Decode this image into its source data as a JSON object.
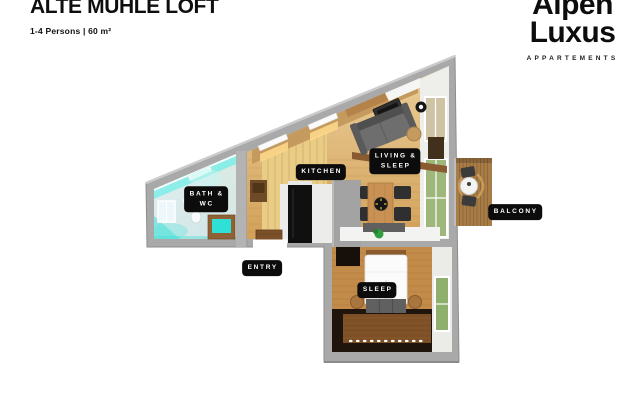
{
  "header": {
    "title": "ALTE MÜHLE LOFT",
    "subtitle": "1-4 Persons | 60 m²"
  },
  "logo": {
    "line1": "Alpen",
    "line2": "Luxus",
    "tagline": "APPARTEMENTS"
  },
  "floorplan": {
    "labels": {
      "bath_line1": "BATH &",
      "bath_line2": "WC",
      "kitchen": "KITCHEN",
      "living_line1": "LIVING &",
      "living_line2": "SLEEP",
      "balcony": "BALCONY",
      "entry": "ENTRY",
      "sleep": "SLEEP"
    },
    "rooms": [
      "Bath & WC",
      "Kitchen",
      "Living & Sleep",
      "Sleep",
      "Balcony",
      "Entry"
    ],
    "colors": {
      "wall_gray": "#a9a9a9",
      "wood_floor": "#d9ab63",
      "accent_cyan": "#3ee3d9",
      "balcony_wood": "#a87c46",
      "sleep_floor_dark": "#20150c",
      "label_bg": "#0c0c0c",
      "label_text": "#ffffff"
    }
  }
}
